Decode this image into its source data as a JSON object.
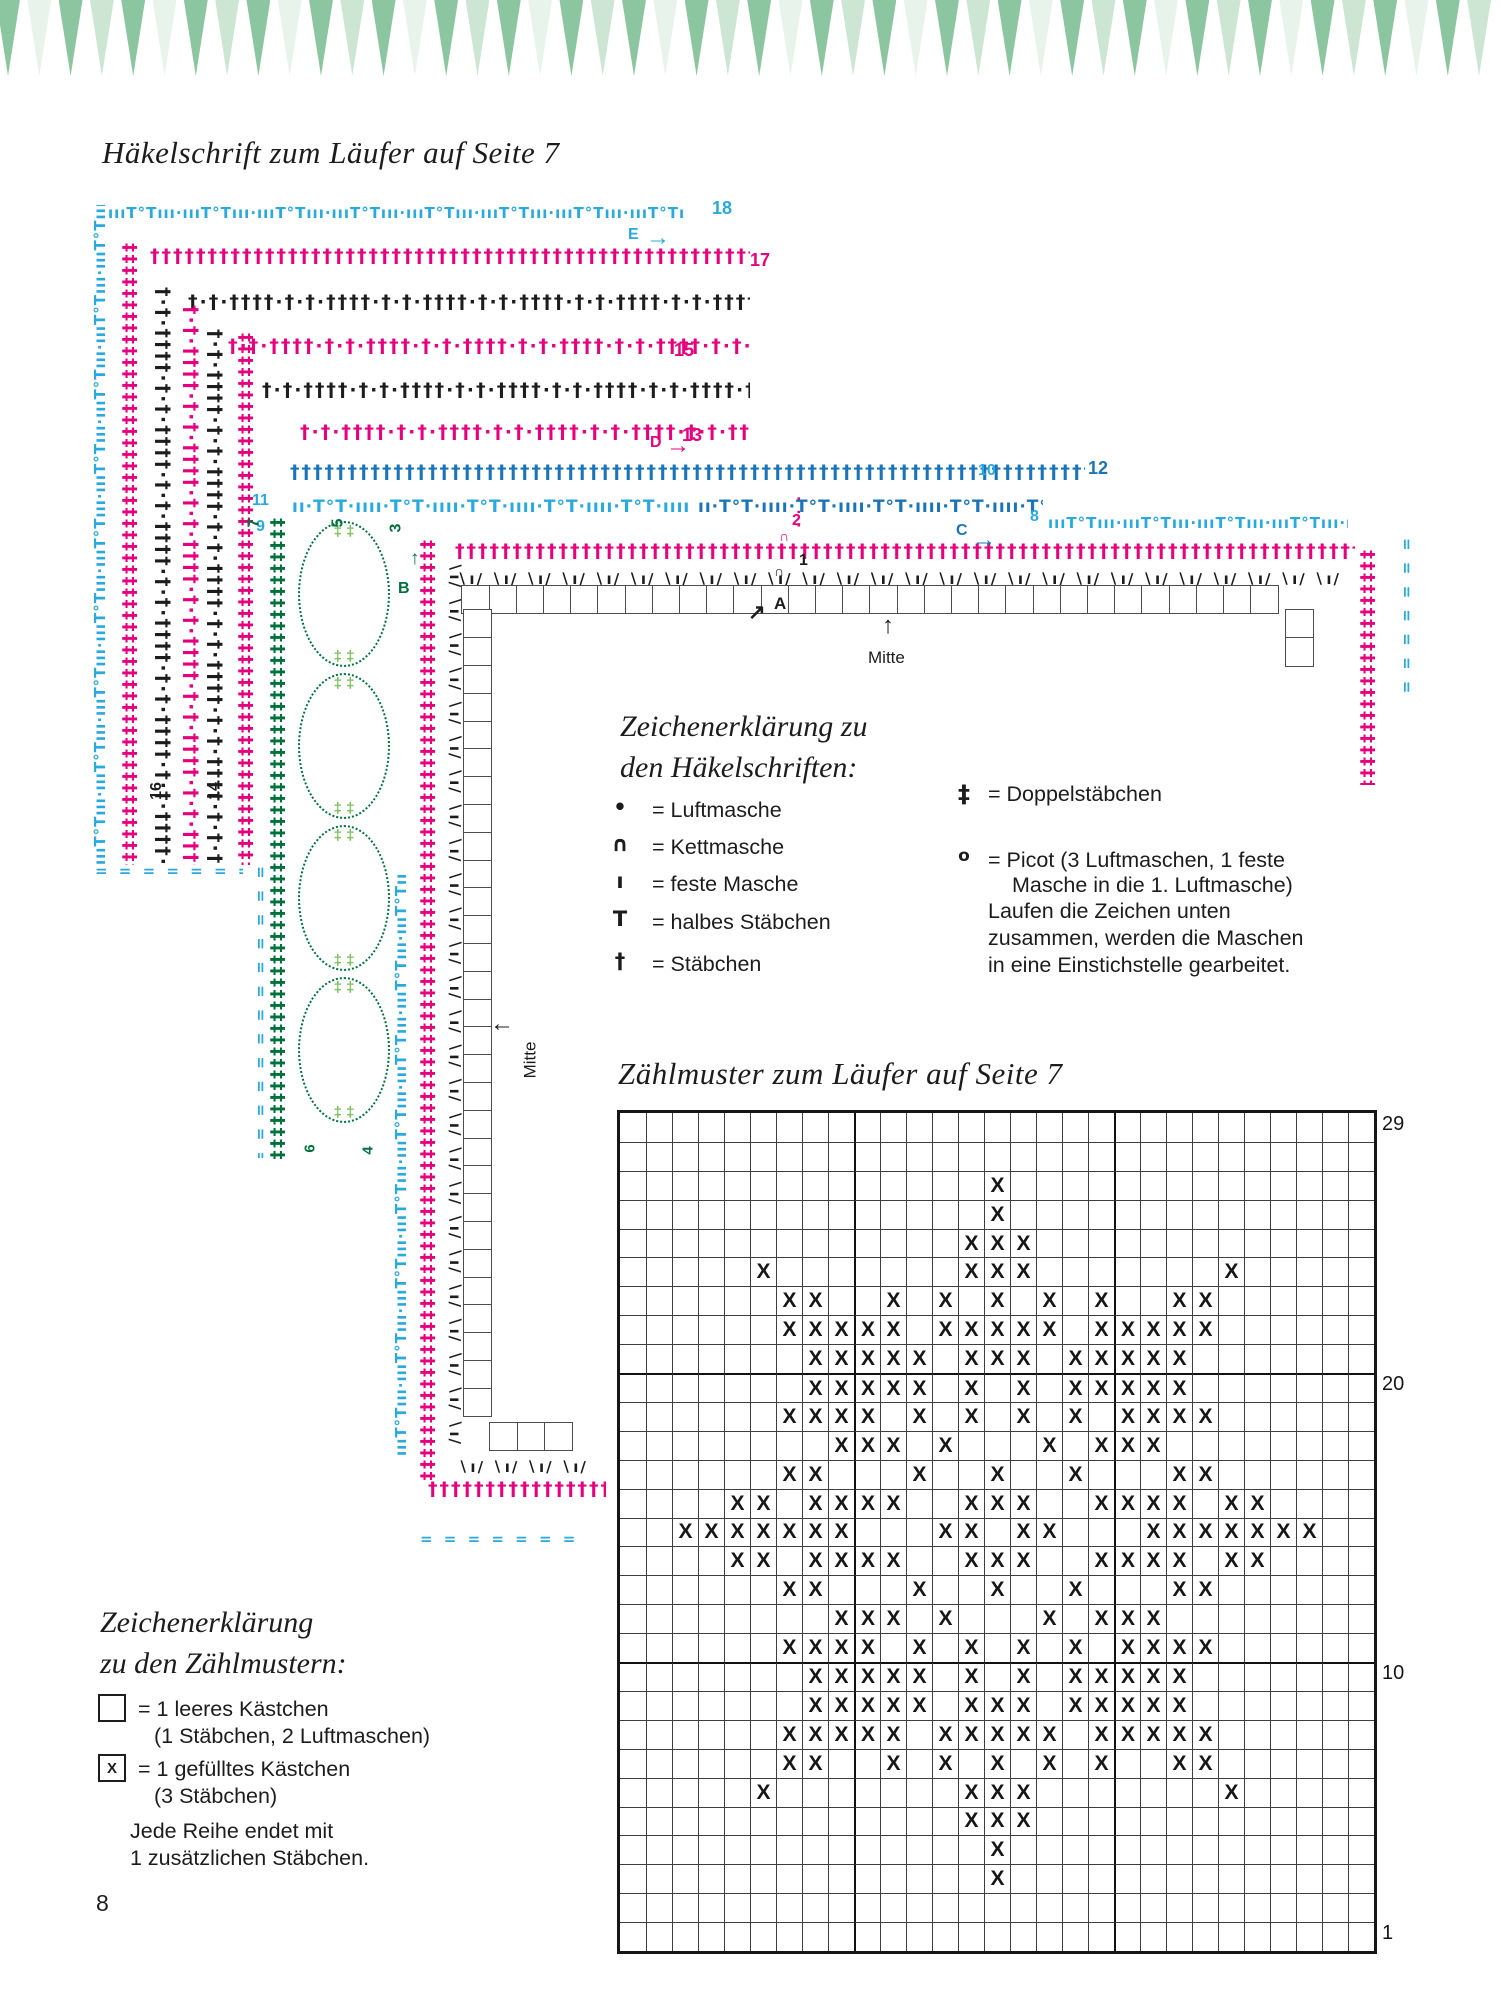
{
  "page": {
    "number": "8"
  },
  "titles": {
    "haekelschrift": "Häkelschrift zum Läufer auf Seite 7",
    "zaehlmuster": "Zählmuster zum Läufer auf Seite 7"
  },
  "colors": {
    "magenta": "#E5007D",
    "cyan": "#2AA9DF",
    "blue": "#1C74B8",
    "green": "#00703C",
    "lightgreen": "#74BE54",
    "black": "#1C1C1C",
    "banner": [
      "#8CC6A0",
      "#E8F3EC",
      "#8CC6A0",
      "#CDE6D4"
    ]
  },
  "banner": {
    "count": 48,
    "period": 31.3
  },
  "haekelschrift": {
    "mitte_top": "Mitte",
    "mitte_left": "Mitte",
    "bands": [
      {
        "type": "picot",
        "color": "cyan",
        "orient": "h",
        "x": 108,
        "y": 198,
        "len": 578
      },
      {
        "type": "dense",
        "color": "magenta",
        "orient": "h",
        "x": 150,
        "y": 241,
        "len": 600
      },
      {
        "type": "groups",
        "color": "black",
        "orient": "h",
        "x": 188,
        "y": 287,
        "len": 562
      },
      {
        "type": "groups",
        "color": "magenta",
        "orient": "h",
        "x": 228,
        "y": 331,
        "len": 522
      },
      {
        "type": "groups",
        "color": "black",
        "orient": "h",
        "x": 262,
        "y": 375,
        "len": 488
      },
      {
        "type": "groups",
        "color": "magenta",
        "orient": "h",
        "x": 300,
        "y": 417,
        "len": 450
      },
      {
        "type": "dense",
        "color": "blue",
        "orient": "h",
        "x": 290,
        "y": 457,
        "len": 795
      },
      {
        "type": "fans",
        "color": "cyan",
        "orient": "h",
        "x": 292,
        "y": 492,
        "len": 400
      },
      {
        "type": "fans",
        "color": "blue",
        "orient": "h",
        "x": 698,
        "y": 492,
        "len": 345
      },
      {
        "type": "picot",
        "color": "cyan",
        "orient": "h",
        "x": 1048,
        "y": 508,
        "len": 300
      },
      {
        "type": "dense",
        "color": "magenta",
        "orient": "h",
        "x": 455,
        "y": 536,
        "len": 900
      },
      {
        "type": "hatch",
        "color": "black",
        "orient": "h",
        "x": 457,
        "y": 564,
        "len": 890
      },
      {
        "type": "dashes",
        "color": "cyan",
        "orient": "h",
        "x": 95,
        "y": 856,
        "len": 148
      },
      {
        "type": "hatch",
        "color": "black",
        "orient": "h",
        "x": 458,
        "y": 1452,
        "len": 130
      },
      {
        "type": "dense",
        "color": "magenta",
        "orient": "h",
        "x": 428,
        "y": 1474,
        "len": 178
      },
      {
        "type": "dashes",
        "color": "cyan",
        "orient": "h",
        "x": 420,
        "y": 1524,
        "len": 160
      },
      {
        "type": "dots",
        "color": "magenta",
        "orient": "v",
        "x": 786,
        "y": 496,
        "len": 40,
        "face": "right"
      },
      {
        "type": "picot",
        "color": "cyan",
        "orient": "v",
        "x": 85,
        "y": 205,
        "len": 660,
        "face": "left"
      },
      {
        "type": "dense2",
        "color": "magenta",
        "orient": "v",
        "x": 118,
        "y": 243,
        "len": 622,
        "face": "right"
      },
      {
        "type": "groups",
        "color": "black",
        "orient": "v",
        "x": 152,
        "y": 287,
        "len": 578,
        "face": "right"
      },
      {
        "type": "groups",
        "color": "magenta",
        "orient": "v",
        "x": 180,
        "y": 305,
        "len": 560,
        "face": "right"
      },
      {
        "type": "groups",
        "color": "black",
        "orient": "v",
        "x": 204,
        "y": 329,
        "len": 536,
        "face": "right"
      },
      {
        "type": "dense2",
        "color": "magenta",
        "orient": "v",
        "x": 234,
        "y": 333,
        "len": 532,
        "face": "right"
      },
      {
        "type": "dashes",
        "color": "cyan",
        "orient": "v",
        "x": 250,
        "y": 866,
        "len": 292,
        "face": "right"
      },
      {
        "type": "dense2",
        "color": "green",
        "orient": "v",
        "x": 266,
        "y": 518,
        "len": 642,
        "face": "right"
      },
      {
        "type": "picot",
        "color": "cyan",
        "orient": "v",
        "x": 386,
        "y": 874,
        "len": 582,
        "face": "left"
      },
      {
        "type": "dense2",
        "color": "magenta",
        "orient": "v",
        "x": 416,
        "y": 540,
        "len": 942,
        "face": "right"
      },
      {
        "type": "hatch",
        "color": "black",
        "orient": "v",
        "x": 444,
        "y": 562,
        "len": 892,
        "face": "right"
      },
      {
        "type": "dense2",
        "color": "magenta",
        "orient": "v",
        "x": 1356,
        "y": 550,
        "len": 235,
        "face": "right"
      },
      {
        "type": "dashes",
        "color": "cyan",
        "orient": "v",
        "x": 1396,
        "y": 538,
        "len": 168,
        "face": "right"
      }
    ],
    "greenfans": {
      "x": 296,
      "y": 518,
      "w": 96,
      "h": 642,
      "circles": 4,
      "tip": "‡ ‡"
    },
    "boxstrips": [
      {
        "dir": "h",
        "x": 463,
        "y": 585,
        "count": 30
      },
      {
        "dir": "v",
        "x": 463,
        "y": 611,
        "count": 29
      },
      {
        "dir": "h",
        "x": 491,
        "y": 1422,
        "count": 3
      },
      {
        "dir": "v",
        "x": 1285,
        "y": 611,
        "count": 2
      }
    ],
    "labels": [
      {
        "text": "18",
        "x": 712,
        "y": 198,
        "color": "cyan",
        "fs": 18
      },
      {
        "text": "E",
        "x": 628,
        "y": 226,
        "color": "cyan",
        "fs": 16
      },
      {
        "text": "→",
        "x": 646,
        "y": 224,
        "color": "cyan",
        "fs": 24
      },
      {
        "text": "17",
        "x": 750,
        "y": 250,
        "color": "magenta",
        "fs": 18
      },
      {
        "text": "15",
        "x": 674,
        "y": 340,
        "color": "magenta",
        "fs": 18
      },
      {
        "text": "13",
        "x": 682,
        "y": 425,
        "color": "magenta",
        "fs": 18
      },
      {
        "text": "D",
        "x": 650,
        "y": 434,
        "color": "magenta",
        "fs": 16
      },
      {
        "text": "→",
        "x": 666,
        "y": 432,
        "color": "magenta",
        "fs": 24
      },
      {
        "text": "12",
        "x": 1088,
        "y": 458,
        "color": "blue",
        "fs": 18
      },
      {
        "text": "11",
        "x": 252,
        "y": 492,
        "color": "cyan",
        "fs": 16
      },
      {
        "text": "9",
        "x": 256,
        "y": 518,
        "color": "cyan",
        "fs": 16
      },
      {
        "text": "10",
        "x": 978,
        "y": 462,
        "color": "cyan",
        "fs": 16
      },
      {
        "text": "8",
        "x": 1030,
        "y": 508,
        "color": "cyan",
        "fs": 16
      },
      {
        "text": "C",
        "x": 956,
        "y": 522,
        "color": "blue",
        "fs": 16
      },
      {
        "text": "→",
        "x": 972,
        "y": 526,
        "color": "blue",
        "fs": 24
      },
      {
        "text": "2",
        "x": 792,
        "y": 512,
        "color": "magenta",
        "fs": 16
      },
      {
        "text": "∩",
        "x": 779,
        "y": 528,
        "color": "magenta",
        "fs": 14
      },
      {
        "text": "1",
        "x": 799,
        "y": 552,
        "color": "black",
        "fs": 16
      },
      {
        "text": "∩",
        "x": 774,
        "y": 563,
        "color": "black",
        "fs": 14
      },
      {
        "text": "A",
        "x": 774,
        "y": 594,
        "color": "black",
        "fs": 17
      },
      {
        "text": "↗",
        "x": 748,
        "y": 600,
        "color": "black",
        "fs": 21
      },
      {
        "text": "B",
        "x": 398,
        "y": 580,
        "color": "green",
        "fs": 16
      },
      {
        "text": "↑",
        "x": 410,
        "y": 548,
        "color": "green",
        "fs": 19
      },
      {
        "text": "7",
        "x": 250,
        "y": 514,
        "color": "green",
        "fs": 16,
        "rot": -90
      },
      {
        "text": "5",
        "x": 334,
        "y": 514,
        "color": "green",
        "fs": 16,
        "rot": -90
      },
      {
        "text": "3",
        "x": 392,
        "y": 519,
        "color": "green",
        "fs": 16,
        "rot": -90
      },
      {
        "text": "6",
        "x": 306,
        "y": 1140,
        "color": "green",
        "fs": 15,
        "rot": -90
      },
      {
        "text": "4",
        "x": 364,
        "y": 1142,
        "color": "green",
        "fs": 15,
        "rot": -90
      },
      {
        "text": "16",
        "x": 148,
        "y": 782,
        "color": "black",
        "fs": 16,
        "rot": -90
      },
      {
        "text": "14",
        "x": 206,
        "y": 782,
        "color": "black",
        "fs": 16,
        "rot": -90
      },
      {
        "text": "↑",
        "x": 882,
        "y": 612,
        "color": "black",
        "fs": 24
      },
      {
        "text": "←",
        "x": 490,
        "y": 1010,
        "color": "black",
        "fs": 24
      }
    ]
  },
  "legend_haekelschriften": {
    "heading1": "Zeichenerklärung zu",
    "heading2": "den Häkelschriften:",
    "items_left": [
      {
        "symbol": "•",
        "text": "= Luftmasche"
      },
      {
        "symbol": "∩",
        "text": "= Kettmasche"
      },
      {
        "symbol": "ı",
        "text": "= feste Masche"
      },
      {
        "symbol": "Τ",
        "text": "= halbes Stäbchen"
      },
      {
        "symbol": "†",
        "text": "= Stäbchen"
      }
    ],
    "items_right": [
      {
        "symbol": "‡",
        "text": "= Doppelstäbchen",
        "text2": ""
      },
      {
        "symbol": "o",
        "text": "= Picot (3 Luftmaschen, 1 feste",
        "text2": "Masche in die 1. Luftmasche)"
      }
    ],
    "note_lines": [
      "Laufen die Zeichen unten",
      "zusammen, werden die Maschen",
      "in eine Einstichstelle gearbeitet."
    ]
  },
  "legend_zaehlmuster": {
    "heading1": "Zeichenerklärung",
    "heading2": "zu den Zählmustern:",
    "item1_text": "= 1 leeres Kästchen",
    "item1_text2": "(1 Stäbchen, 2 Luftmaschen)",
    "item2_symbol": "X",
    "item2_text": "= 1 gefülltes Kästchen",
    "item2_text2": "(3 Stäbchen)",
    "note_lines": [
      "Jede Reihe endet mit",
      "1 zusätzlichen Stäbchen."
    ]
  },
  "chart_data": {
    "type": "heatmap",
    "title": "Zählmuster zum Läufer auf Seite 7",
    "cols": 29,
    "rows": 29,
    "legend_empty": "1 leeres Kästchen (1 Stäbchen, 2 Luftmaschen)",
    "legend_filled": "1 gefülltes Kästchen (3 Stäbchen)",
    "row_labels": [
      {
        "row_index": 0,
        "label": "29"
      },
      {
        "row_index": 9,
        "label": "20"
      },
      {
        "row_index": 19,
        "label": "10"
      },
      {
        "row_index": 28,
        "label": "1"
      }
    ],
    "grid_rows": [
      ".............................",
      ".............................",
      "..............X..............",
      "..............X..............",
      ".............XXX.............",
      ".....X.......XXX.......X.....",
      "......XX..X.X.X.X.X..XX......",
      "......XXXXX.XXXXX.XXXXX......",
      ".......XXXXX.XXX.XXXXX.......",
      ".......XXXXX.X.X.XXXXX.......",
      "......XXXX.X.X.X.X.XXXX......",
      "........XXX.X...X.XXX........",
      "......XX...X..X..X...XX......",
      "....XX.XXXX..XXX..XXXX.XX....",
      "..XXXXXXX...XX.XX...XXXXXXX..",
      "....XX.XXXX..XXX..XXXX.XX....",
      "......XX...X..X..X...XX......",
      "........XXX.X...X.XXX........",
      "......XXXX.X.X.X.X.XXXX......",
      ".......XXXXX.X.X.XXXXX.......",
      ".......XXXXX.XXX.XXXXX.......",
      "......XXXXX.XXXXX.XXXXX......",
      "......XX..X.X.X.X.X..XX......",
      ".....X.......XXX.......X.....",
      ".............XXX.............",
      "..............X..............",
      "..............X..............",
      ".............................",
      "............................."
    ]
  }
}
